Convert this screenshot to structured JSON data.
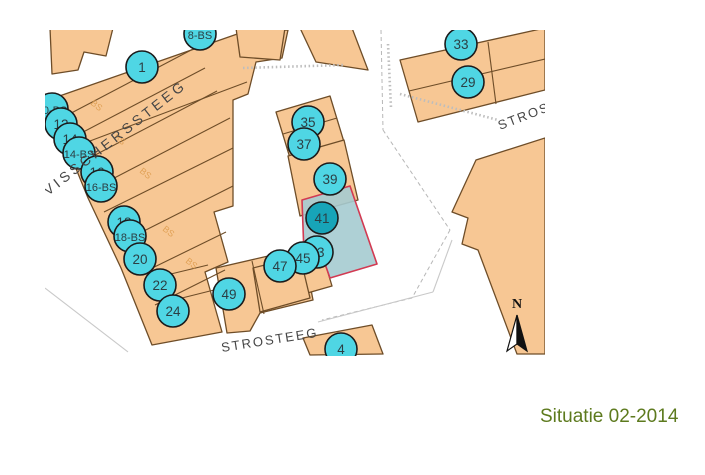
{
  "title": {
    "label": "Situatie 02-2014",
    "color": "#5d7a1e"
  },
  "map": {
    "streets": [
      {
        "id": "visscherssteeg",
        "label": "VISSCHERSSTEEG"
      },
      {
        "id": "strosteeg-upper",
        "label": "STROSTEEG"
      },
      {
        "id": "strosteeg-lower",
        "label": "STROSTEEG"
      }
    ],
    "north_label": "N",
    "colors": {
      "building": "#f7c794",
      "building_outline": "#6e4d28",
      "marker_fill": "#4fd6e4",
      "marker_outline": "#1b1b1b",
      "marker_text": "#2b3f44",
      "highlight_marker_fill": "#17a4b8",
      "highlight_marker_outline": "#d23a52",
      "highlight_parcel_fill": "#a5cbd0",
      "highlight_parcel_outline": "#d23a52",
      "street_text": "#464646",
      "bs_label_color": "#dd9b4c",
      "title_color": "#5d7a1e"
    },
    "markers": [
      {
        "label": "1",
        "x": 142,
        "y": 67
      },
      {
        "label": "8-BS",
        "x": 200,
        "y": 34
      },
      {
        "label": "10-BS",
        "x": 52,
        "y": 109
      },
      {
        "label": "12",
        "x": 61,
        "y": 124
      },
      {
        "label": "14",
        "x": 70,
        "y": 139
      },
      {
        "label": "14-BS",
        "x": 79,
        "y": 153
      },
      {
        "label": "16",
        "x": 97,
        "y": 172
      },
      {
        "label": "16-BS",
        "x": 101,
        "y": 186
      },
      {
        "label": "18",
        "x": 124,
        "y": 222
      },
      {
        "label": "18-BS",
        "x": 130,
        "y": 236
      },
      {
        "label": "20",
        "x": 140,
        "y": 259
      },
      {
        "label": "22",
        "x": 160,
        "y": 285
      },
      {
        "label": "24",
        "x": 173,
        "y": 311
      },
      {
        "label": "33",
        "x": 461,
        "y": 44
      },
      {
        "label": "29",
        "x": 468,
        "y": 82
      },
      {
        "label": "35",
        "x": 308,
        "y": 122
      },
      {
        "label": "37",
        "x": 304,
        "y": 144
      },
      {
        "label": "39",
        "x": 330,
        "y": 179
      },
      {
        "label": "41",
        "x": 322,
        "y": 218,
        "highlight": true
      },
      {
        "label": "43",
        "x": 317,
        "y": 252
      },
      {
        "label": "45",
        "x": 303,
        "y": 258
      },
      {
        "label": "47",
        "x": 280,
        "y": 266
      },
      {
        "label": "49",
        "x": 229,
        "y": 294
      },
      {
        "label": "4",
        "x": 341,
        "y": 349
      }
    ],
    "bs_labels": [
      {
        "label": "BS",
        "x": 90,
        "y": 104
      },
      {
        "label": "BS",
        "x": 113,
        "y": 138
      },
      {
        "label": "BS",
        "x": 139,
        "y": 172
      },
      {
        "label": "BS",
        "x": 162,
        "y": 230
      },
      {
        "label": "BS",
        "x": 185,
        "y": 262
      }
    ]
  }
}
